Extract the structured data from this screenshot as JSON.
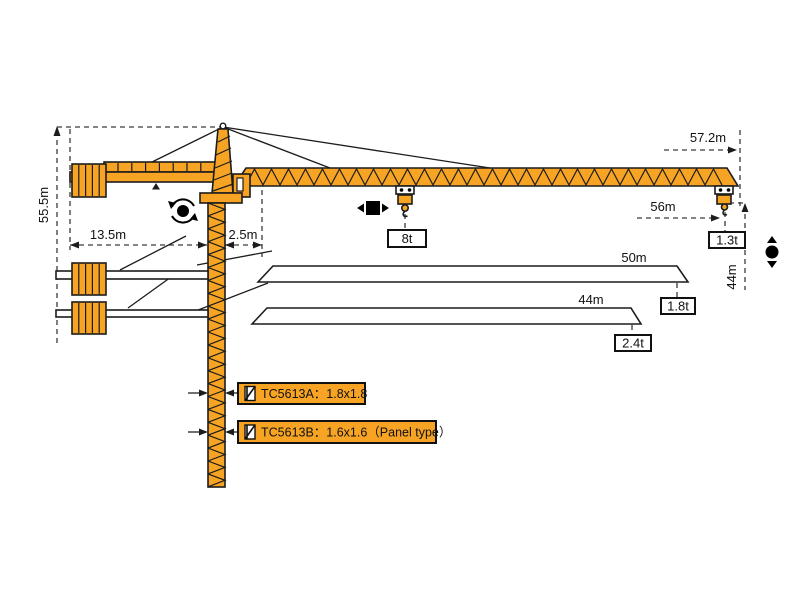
{
  "colors": {
    "crane_orange": "#F7A424",
    "outline": "#1c1c1c",
    "dash": "#3a3a3a"
  },
  "dimensions": {
    "tower_height": "55.5m",
    "counter_jib_length": "13.5m",
    "jib_root_offset": "2.5m",
    "max_jib_span": "57.2m",
    "max_working_radius": "56m",
    "hook_height_right": "44m"
  },
  "capacities": {
    "trolley_load": "8t",
    "tip_load_57m": "1.3t"
  },
  "jib_options": [
    {
      "length": "50m",
      "tip_load": "1.8t"
    },
    {
      "length": "44m",
      "tip_load": "2.4t"
    }
  ],
  "mast_options": [
    {
      "label": "TC5613A：1.8x1.8"
    },
    {
      "label": "TC5613B：1.6x1.6（Panel type）"
    }
  ]
}
